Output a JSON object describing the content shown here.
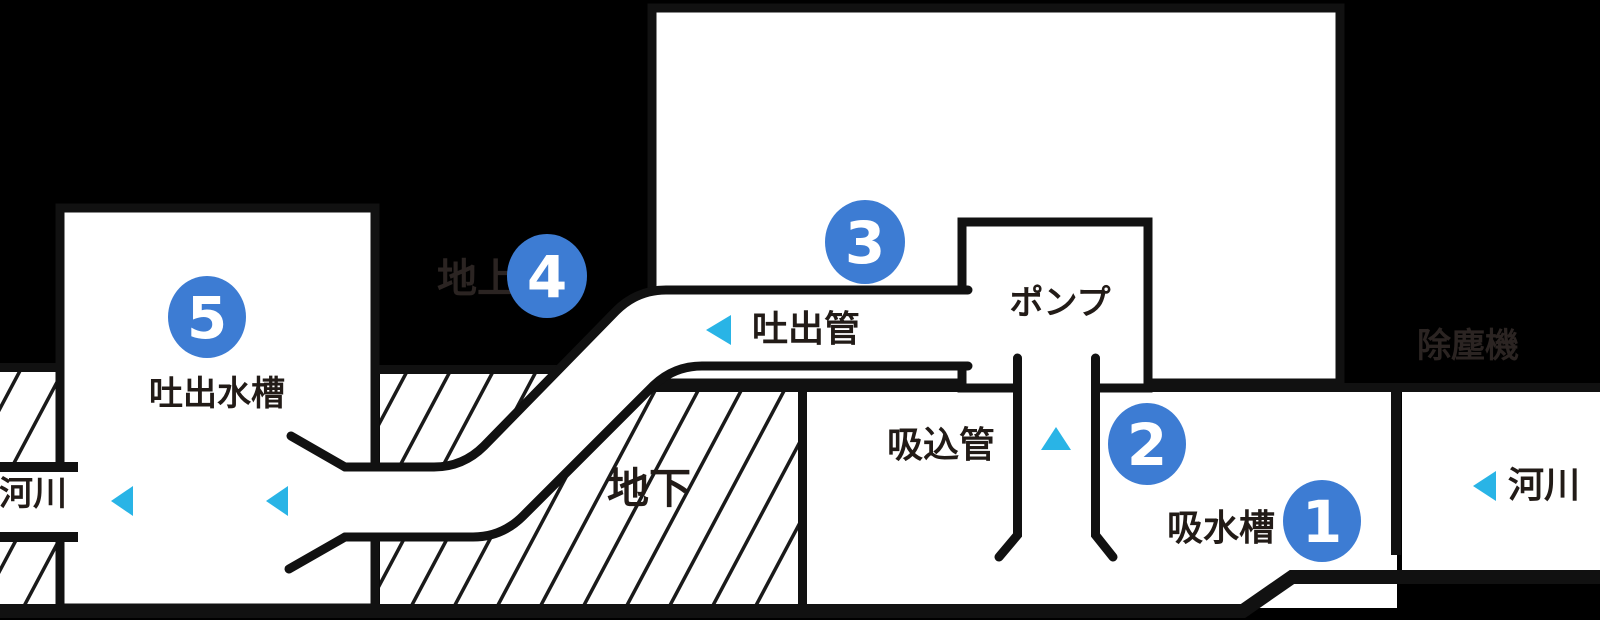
{
  "diagram": {
    "type": "pump-station-cross-section",
    "labels": {
      "discharge_tank": "吐出水槽",
      "river_left": "河川",
      "above_ground": "地上",
      "underground": "地下",
      "discharge_pipe": "吐出管",
      "pump": "ポンプ",
      "suction_pipe": "吸込管",
      "suction_tank": "吸水槽",
      "river_right": "河川",
      "intake_screen": "除塵機"
    },
    "markers": [
      {
        "number": "1"
      },
      {
        "number": "2"
      },
      {
        "number": "3"
      },
      {
        "number": "4"
      },
      {
        "number": "5"
      }
    ],
    "icons": {
      "flow_arrow_left": "left-pointing triangle",
      "flow_arrow_up": "up-pointing triangle"
    },
    "colors": {
      "bg": "#000000",
      "line": "#111111",
      "accent": "#3d7cd3",
      "cyan": "#29b4e6",
      "ink": "#221b17",
      "faint": "#2b2422",
      "hatch_line": "#1a1a1a",
      "white": "#ffffff"
    }
  }
}
